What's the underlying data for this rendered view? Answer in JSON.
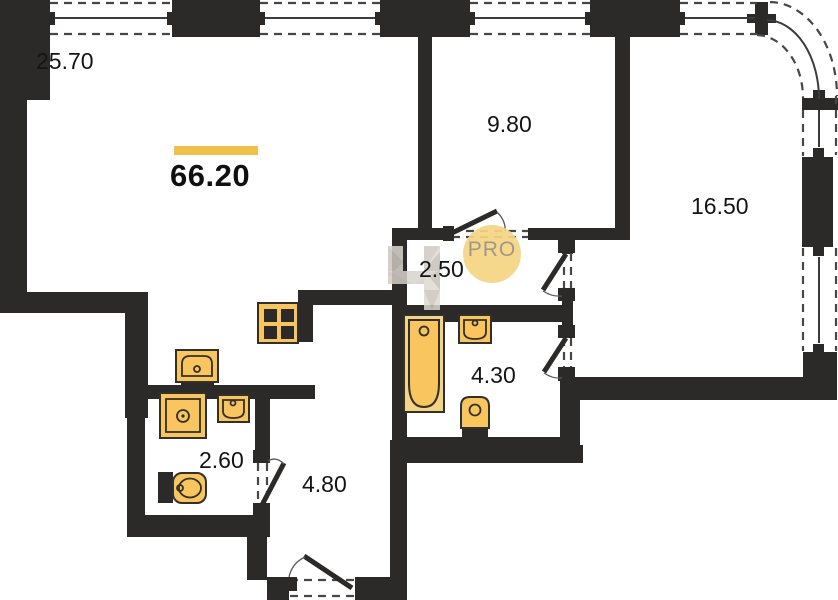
{
  "plan": {
    "total_area": "66.20",
    "rooms": [
      {
        "name": "living-room",
        "area": "25.70"
      },
      {
        "name": "bedroom",
        "area": "9.80"
      },
      {
        "name": "bedroom-2",
        "area": "16.50"
      },
      {
        "name": "hall",
        "area": "2.50"
      },
      {
        "name": "bathroom",
        "area": "4.30"
      },
      {
        "name": "wc",
        "area": "2.60"
      },
      {
        "name": "entry-hall",
        "area": "4.80"
      }
    ],
    "watermark": {
      "text": "PRO"
    },
    "fixtures": [
      "stove",
      "kitchen-sink",
      "washing-machine",
      "wc-sink",
      "wc-toilet",
      "bathtub",
      "bath-sink",
      "bath-toilet"
    ],
    "colors": {
      "wall": "#2b2a28",
      "dash": "#474747",
      "line": "#3c3c3c",
      "fixture": "#f8c55e",
      "fixture-light": "#f6d284",
      "accent-bar": "#f0c04b",
      "watermark-circle": "#f6d584",
      "watermark-text": "#97907f",
      "logo-gray": "#d6d2ca"
    }
  }
}
